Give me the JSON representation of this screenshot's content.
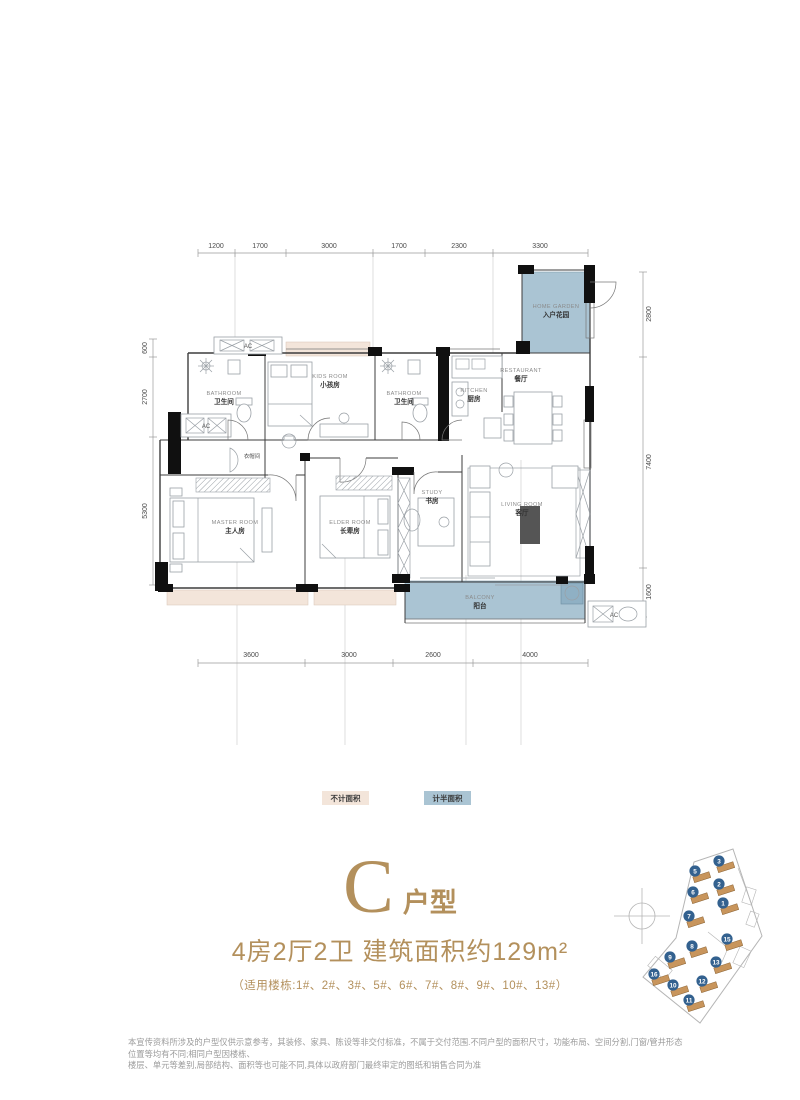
{
  "floor_plan": {
    "dimensions": {
      "top": [
        "1200",
        "1700",
        "3000",
        "1700",
        "2300",
        "3300"
      ],
      "bottom": [
        "3600",
        "3000",
        "2600",
        "4000"
      ],
      "left": [
        "600",
        "2700",
        "5300"
      ],
      "right": [
        "2800",
        "7400",
        "1600"
      ]
    },
    "rooms": [
      {
        "id": "bathroom-1",
        "en": "BATHROOM",
        "zh": "卫生间"
      },
      {
        "id": "kids-room",
        "en": "KIDS ROOM",
        "zh": "小孩房"
      },
      {
        "id": "bathroom-2",
        "en": "BATHROOM",
        "zh": "卫生间"
      },
      {
        "id": "kitchen",
        "en": "KITCHEN",
        "zh": "厨房"
      },
      {
        "id": "restaurant",
        "en": "RESTAURANT",
        "zh": "餐厅"
      },
      {
        "id": "home-garden",
        "en": "HOME GARDEN",
        "zh": "入户花园"
      },
      {
        "id": "cloakroom",
        "en": "",
        "zh": "衣帽间"
      },
      {
        "id": "master-room",
        "en": "MASTER ROOM",
        "zh": "主人房"
      },
      {
        "id": "elder-room",
        "en": "ELDER ROOM",
        "zh": "长辈房"
      },
      {
        "id": "study",
        "en": "STUDY",
        "zh": "书房"
      },
      {
        "id": "living-room",
        "en": "LIVING ROOM",
        "zh": "客厅"
      },
      {
        "id": "balcony",
        "en": "BALCONY",
        "zh": "阳台"
      }
    ],
    "ac_label": "AC",
    "colors": {
      "half_area": "#aac4d3",
      "no_area": "#f3e5da"
    }
  },
  "legend": {
    "items": [
      {
        "label": "不计面积",
        "color": "#f3e5da"
      },
      {
        "label": "计半面积",
        "color": "#aac4d3"
      }
    ]
  },
  "title": {
    "letter": "C",
    "suffix": "户型",
    "subtitle": "4房2厅2卫 建筑面积约129m²",
    "note": "（适用楼栋:1#、2#、3#、5#、6#、7#、8#、9#、10#、13#）",
    "accent_color": "#b3905c"
  },
  "site_plan": {
    "buildings": [
      "3",
      "5",
      "2",
      "6",
      "1",
      "7",
      "15",
      "8",
      "9",
      "13",
      "16",
      "12",
      "10",
      "11"
    ]
  },
  "disclaimer": {
    "line1": "本宣传资料所涉及的户型仅供示意参考，其装修、家具、陈设等非交付标准，不属于交付范围.不同户型的面积尺寸，功能布局、空间分割,门窗/管井形态位置等均有不同;相同户型因楼栋、",
    "line2": "楼层、单元等差别,局部结构、面积等也可能不同,具体以政府部门最终审定的图纸和销售合同为准"
  }
}
